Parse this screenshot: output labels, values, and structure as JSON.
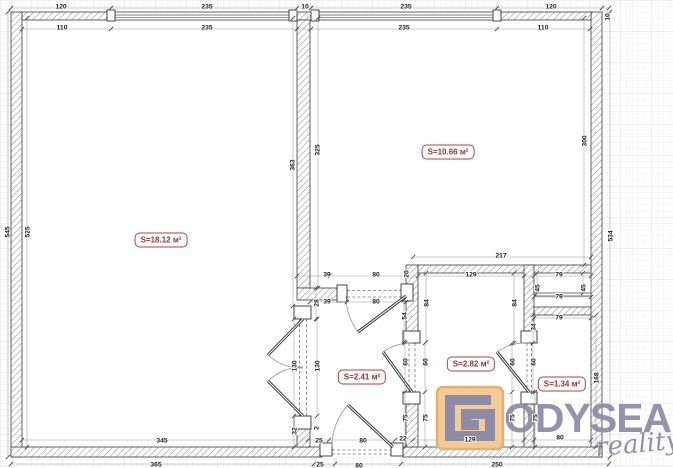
{
  "plan": {
    "title": "apartment floor plan",
    "units": "cm",
    "rooms": [
      {
        "id": "living-room",
        "label": "S=18.12 м²"
      },
      {
        "id": "bedroom",
        "label": "S=10.66 м²"
      },
      {
        "id": "hallway",
        "label": "S=2.41 м²"
      },
      {
        "id": "bathroom",
        "label": "S=2.82 м²"
      },
      {
        "id": "wc",
        "label": "S=1.34 м²"
      }
    ],
    "label_color": "#9e3131",
    "dimensions": [
      {
        "v": "120",
        "x": 61,
        "y": 6
      },
      {
        "v": "235",
        "x": 207,
        "y": 6
      },
      {
        "v": "10",
        "x": 305,
        "y": 6
      },
      {
        "v": "235",
        "x": 406,
        "y": 6
      },
      {
        "v": "120",
        "x": 551,
        "y": 6
      },
      {
        "v": "10",
        "x": 607,
        "y": 17,
        "r": 1
      },
      {
        "v": "110",
        "x": 62,
        "y": 27
      },
      {
        "v": "235",
        "x": 207,
        "y": 27
      },
      {
        "v": "235",
        "x": 404,
        "y": 27
      },
      {
        "v": "110",
        "x": 543,
        "y": 27
      },
      {
        "v": "545",
        "x": 7,
        "y": 232,
        "r": 1
      },
      {
        "v": "525",
        "x": 27,
        "y": 232,
        "r": 1
      },
      {
        "v": "363",
        "x": 292,
        "y": 165,
        "r": 1
      },
      {
        "v": "325",
        "x": 317,
        "y": 150,
        "r": 1
      },
      {
        "v": "300",
        "x": 584,
        "y": 141,
        "r": 1
      },
      {
        "v": "534",
        "x": 610,
        "y": 236,
        "r": 1
      },
      {
        "v": "217",
        "x": 501,
        "y": 255
      },
      {
        "v": "39",
        "x": 327,
        "y": 274
      },
      {
        "v": "80",
        "x": 376,
        "y": 274
      },
      {
        "v": "20",
        "x": 406,
        "y": 274,
        "r": 1
      },
      {
        "v": "129",
        "x": 471,
        "y": 274
      },
      {
        "v": "79",
        "x": 559,
        "y": 274
      },
      {
        "v": "39",
        "x": 327,
        "y": 301
      },
      {
        "v": "80",
        "x": 376,
        "y": 301
      },
      {
        "v": "28",
        "x": 316,
        "y": 303,
        "r": 1
      },
      {
        "v": "54",
        "x": 404,
        "y": 316,
        "r": 1
      },
      {
        "v": "84",
        "x": 426,
        "y": 303,
        "r": 1
      },
      {
        "v": "84",
        "x": 514,
        "y": 303,
        "r": 1
      },
      {
        "v": "45",
        "x": 537,
        "y": 288,
        "r": 1
      },
      {
        "v": "45",
        "x": 583,
        "y": 288,
        "r": 1
      },
      {
        "v": "79",
        "x": 559,
        "y": 296
      },
      {
        "v": "79",
        "x": 559,
        "y": 317
      },
      {
        "v": "34",
        "x": 533,
        "y": 327,
        "r": 1
      },
      {
        "v": "130",
        "x": 294,
        "y": 366,
        "r": 1
      },
      {
        "v": "130",
        "x": 317,
        "y": 366,
        "r": 1
      },
      {
        "v": "60",
        "x": 405,
        "y": 362,
        "r": 1
      },
      {
        "v": "60",
        "x": 425,
        "y": 362,
        "r": 1
      },
      {
        "v": "60",
        "x": 512,
        "y": 362,
        "r": 1
      },
      {
        "v": "60",
        "x": 533,
        "y": 362,
        "r": 1
      },
      {
        "v": "75",
        "x": 405,
        "y": 418,
        "r": 1
      },
      {
        "v": "75",
        "x": 425,
        "y": 418,
        "r": 1
      },
      {
        "v": "75",
        "x": 512,
        "y": 418,
        "r": 1
      },
      {
        "v": "75",
        "x": 535,
        "y": 418,
        "r": 1
      },
      {
        "v": "32",
        "x": 294,
        "y": 431,
        "r": 1
      },
      {
        "v": "2",
        "x": 316,
        "y": 428,
        "r": 1
      },
      {
        "v": "25",
        "x": 319,
        "y": 440
      },
      {
        "v": "345",
        "x": 162,
        "y": 440
      },
      {
        "v": "80",
        "x": 363,
        "y": 440
      },
      {
        "v": "22",
        "x": 403,
        "y": 438
      },
      {
        "v": "129",
        "x": 470,
        "y": 439
      },
      {
        "v": "80",
        "x": 560,
        "y": 437
      },
      {
        "v": "365",
        "x": 156,
        "y": 464
      },
      {
        "v": "25",
        "x": 320,
        "y": 464
      },
      {
        "v": "80",
        "x": 359,
        "y": 465
      },
      {
        "v": "250",
        "x": 497,
        "y": 464
      },
      {
        "v": "168",
        "x": 596,
        "y": 378,
        "r": 1
      }
    ]
  },
  "logo": {
    "brand": "ODYSEA",
    "tagline": "reality",
    "square_fill": "#f3cb95",
    "square_border": "#e2b274",
    "glyph_color": "#8d8ba6",
    "text_color": "#8d8ba6"
  }
}
